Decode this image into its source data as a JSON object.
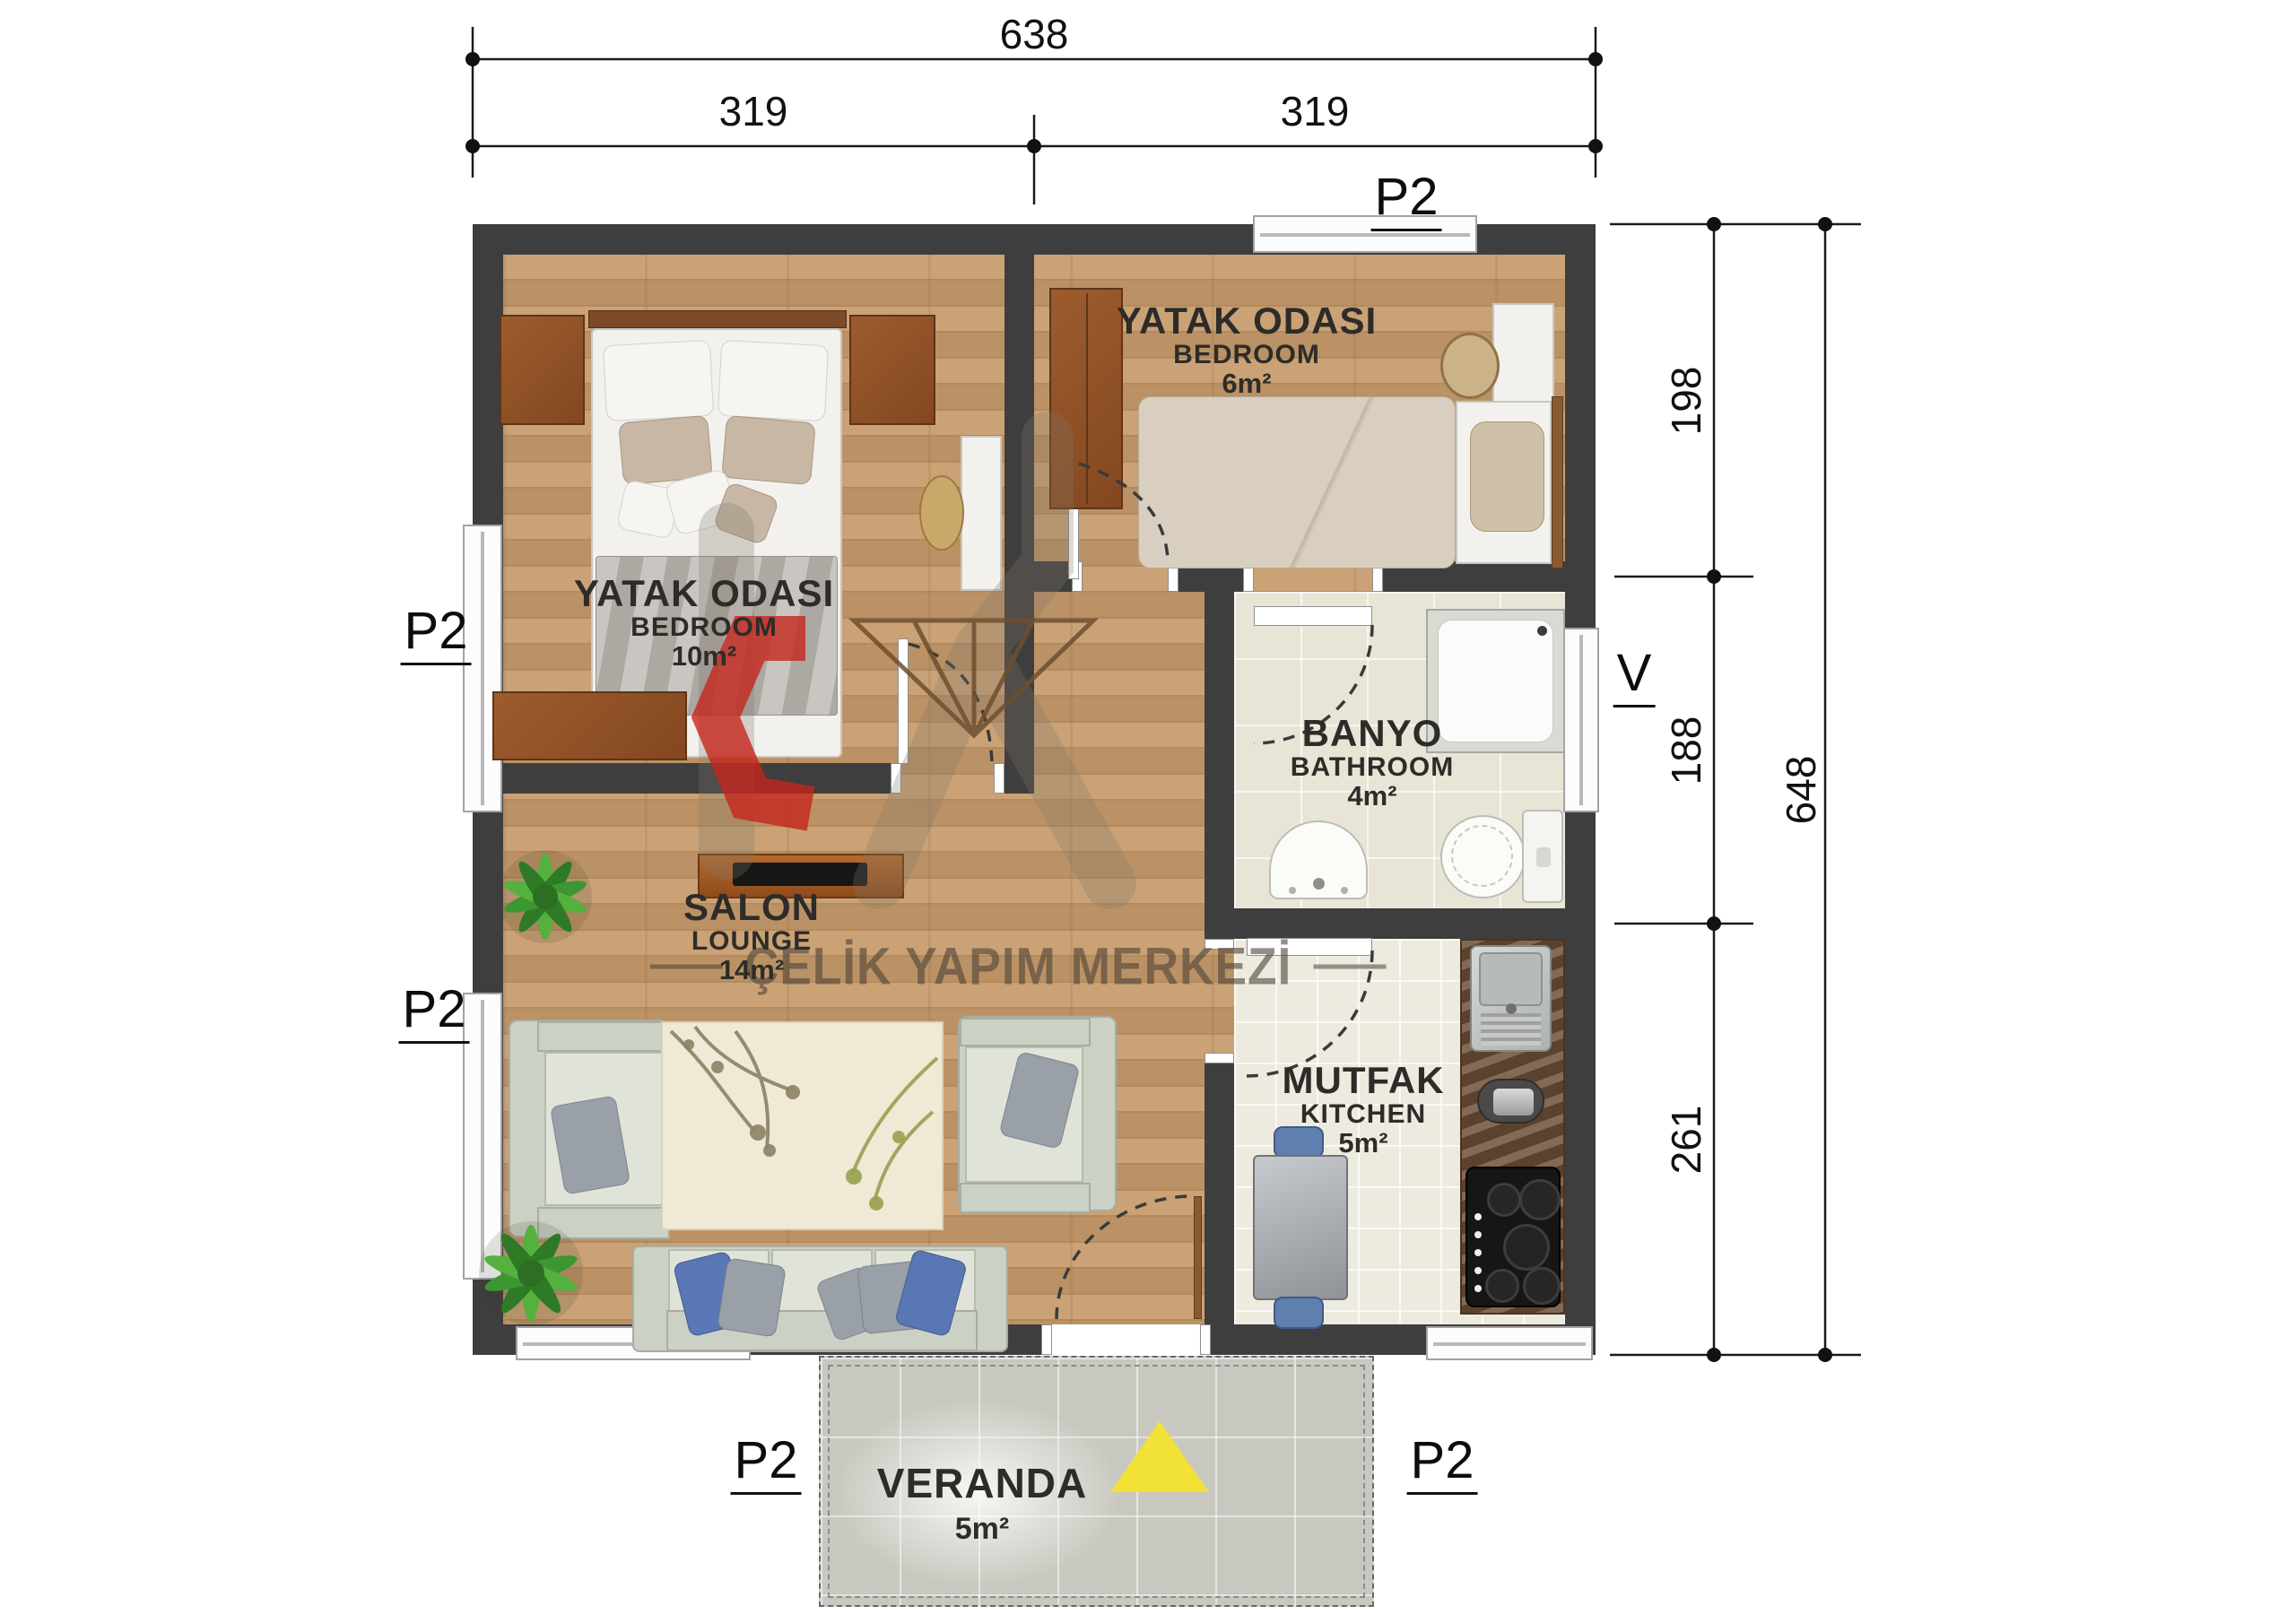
{
  "watermark": "ÇELİK YAPIM MERKEZİ",
  "window_label": "P2",
  "vent_label": "V",
  "dimensions": {
    "total_width": "638",
    "left_half": "319",
    "right_half": "319",
    "seg_top": "198",
    "seg_mid": "188",
    "seg_bottom": "261",
    "total_height": "648"
  },
  "rooms": {
    "bedroom_main": {
      "title": "YATAK ODASI",
      "subtitle": "BEDROOM",
      "area": "10m²"
    },
    "bedroom_small": {
      "title": "YATAK ODASI",
      "subtitle": "BEDROOM",
      "area": "6m²"
    },
    "bathroom": {
      "title": "BANYO",
      "subtitle": "BATHROOM",
      "area": "4m²"
    },
    "lounge": {
      "title": "SALON",
      "subtitle": "LOUNGE",
      "area": "14m²"
    },
    "kitchen": {
      "title": "MUTFAK",
      "subtitle": "KITCHEN",
      "area": "5m²"
    },
    "veranda": {
      "title": "VERANDA",
      "area": "5m²"
    }
  },
  "colors": {
    "wall": "#3f3e3e",
    "wood_floor": "#c59a6a",
    "accent_red": "#c6251d",
    "entrance_triangle": "#f2e136"
  }
}
